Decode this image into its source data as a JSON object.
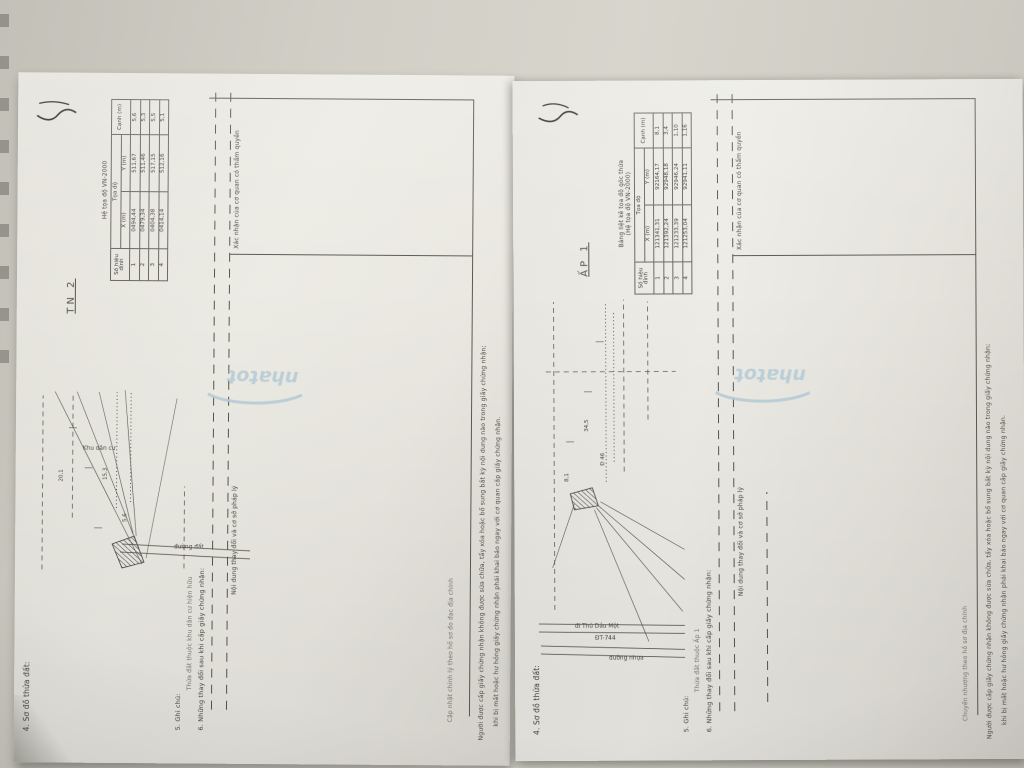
{
  "watermark": {
    "text": "nhatot",
    "color": "#b6cdd9"
  },
  "pages": [
    {
      "section4": "4. Sơ đồ thửa đất:",
      "section5": "5. Ghi chú:",
      "section5_note": "Thửa đất thuộc khu dân cư hiện hữu",
      "section6": "6. Những thay đổi sau khi cấp giấy chứng nhận:",
      "col_left": "Nội dung thay đổi và cơ sở pháp lý",
      "col_right": "Xác nhận của cơ quan có thẩm quyền",
      "entry": "Cập nhật chỉnh lý theo hồ sơ đo đạc địa chính",
      "footer1": "Người được cấp giấy chứng nhận không được sửa chữa, tẩy xóa hoặc bổ sung bất kỳ nội dung nào trong giấy chứng nhận;",
      "footer2": "khi bị mất hoặc hư hỏng giấy chứng nhận phải khai báo ngay với cơ quan cấp giấy chứng nhận.",
      "map_label": "TN 2",
      "coord_table": {
        "title": "Hệ tọa độ VN-2000",
        "subtitle": "",
        "col_point": "Số hiệu đỉnh",
        "col_xy": "Tọa độ",
        "col_x": "X (m)",
        "col_y": "Y (m)",
        "col_edge": "Cạnh (m)",
        "rows": [
          [
            "1",
            "0494,44",
            "511,67",
            "5,6"
          ],
          [
            "2",
            "0479,34",
            "511,46",
            "5,3"
          ],
          [
            "3",
            "0404,38",
            "517,15",
            "5,5"
          ],
          [
            "4",
            "0414,14",
            "512,16",
            "5,1"
          ]
        ]
      },
      "sketch": {
        "road1": "đường đất",
        "area": "Khu dân cư",
        "dim1": "20,1",
        "dim2": "15,3",
        "dim3": "5,6"
      }
    },
    {
      "section4": "4. Sơ đồ thửa đất:",
      "section5": "5. Ghi chú:",
      "section5_note": "Thửa đất thuộc Ấp 1",
      "section6": "6. Những thay đổi sau khi cấp giấy chứng nhận:",
      "col_left": "Nội dung thay đổi và cơ sở pháp lý",
      "col_right": "Xác nhận của cơ quan có thẩm quyền",
      "entry": "Chuyển nhượng theo hồ sơ địa chính",
      "footer1": "Người được cấp giấy chứng nhận không được sửa chữa, tẩy xóa hoặc bổ sung bất kỳ nội dung nào trong giấy chứng nhận;",
      "footer2": "khi bị mất hoặc hư hỏng giấy chứng nhận phải khai báo ngay với cơ quan cấp giấy chứng nhận.",
      "map_label": "ẤP 1",
      "coord_table": {
        "title": "Bảng liệt kê tọa độ góc thửa",
        "subtitle": "(Hệ tọa độ VN-2000)",
        "col_point": "Số hiệu đỉnh",
        "col_xy": "Tọa độ",
        "col_x": "X (m)",
        "col_y": "Y (m)",
        "col_edge": "Cạnh (m)",
        "rows": [
          [
            "1",
            "121341,31",
            "92164,17",
            "8,1"
          ],
          [
            "2",
            "121392,24",
            "92948,18",
            "3,4"
          ],
          [
            "3",
            "121233,39",
            "92946,24",
            "1,10"
          ],
          [
            "4",
            "121253,04",
            "92941,11",
            "1,16"
          ]
        ]
      },
      "sketch": {
        "road1": "ĐT-744",
        "road2": "đi Thủ Dầu Một",
        "area": "đường nhựa",
        "dim1": "8,1",
        "dim2": "34,5",
        "dim3": "Đ 46"
      }
    }
  ]
}
